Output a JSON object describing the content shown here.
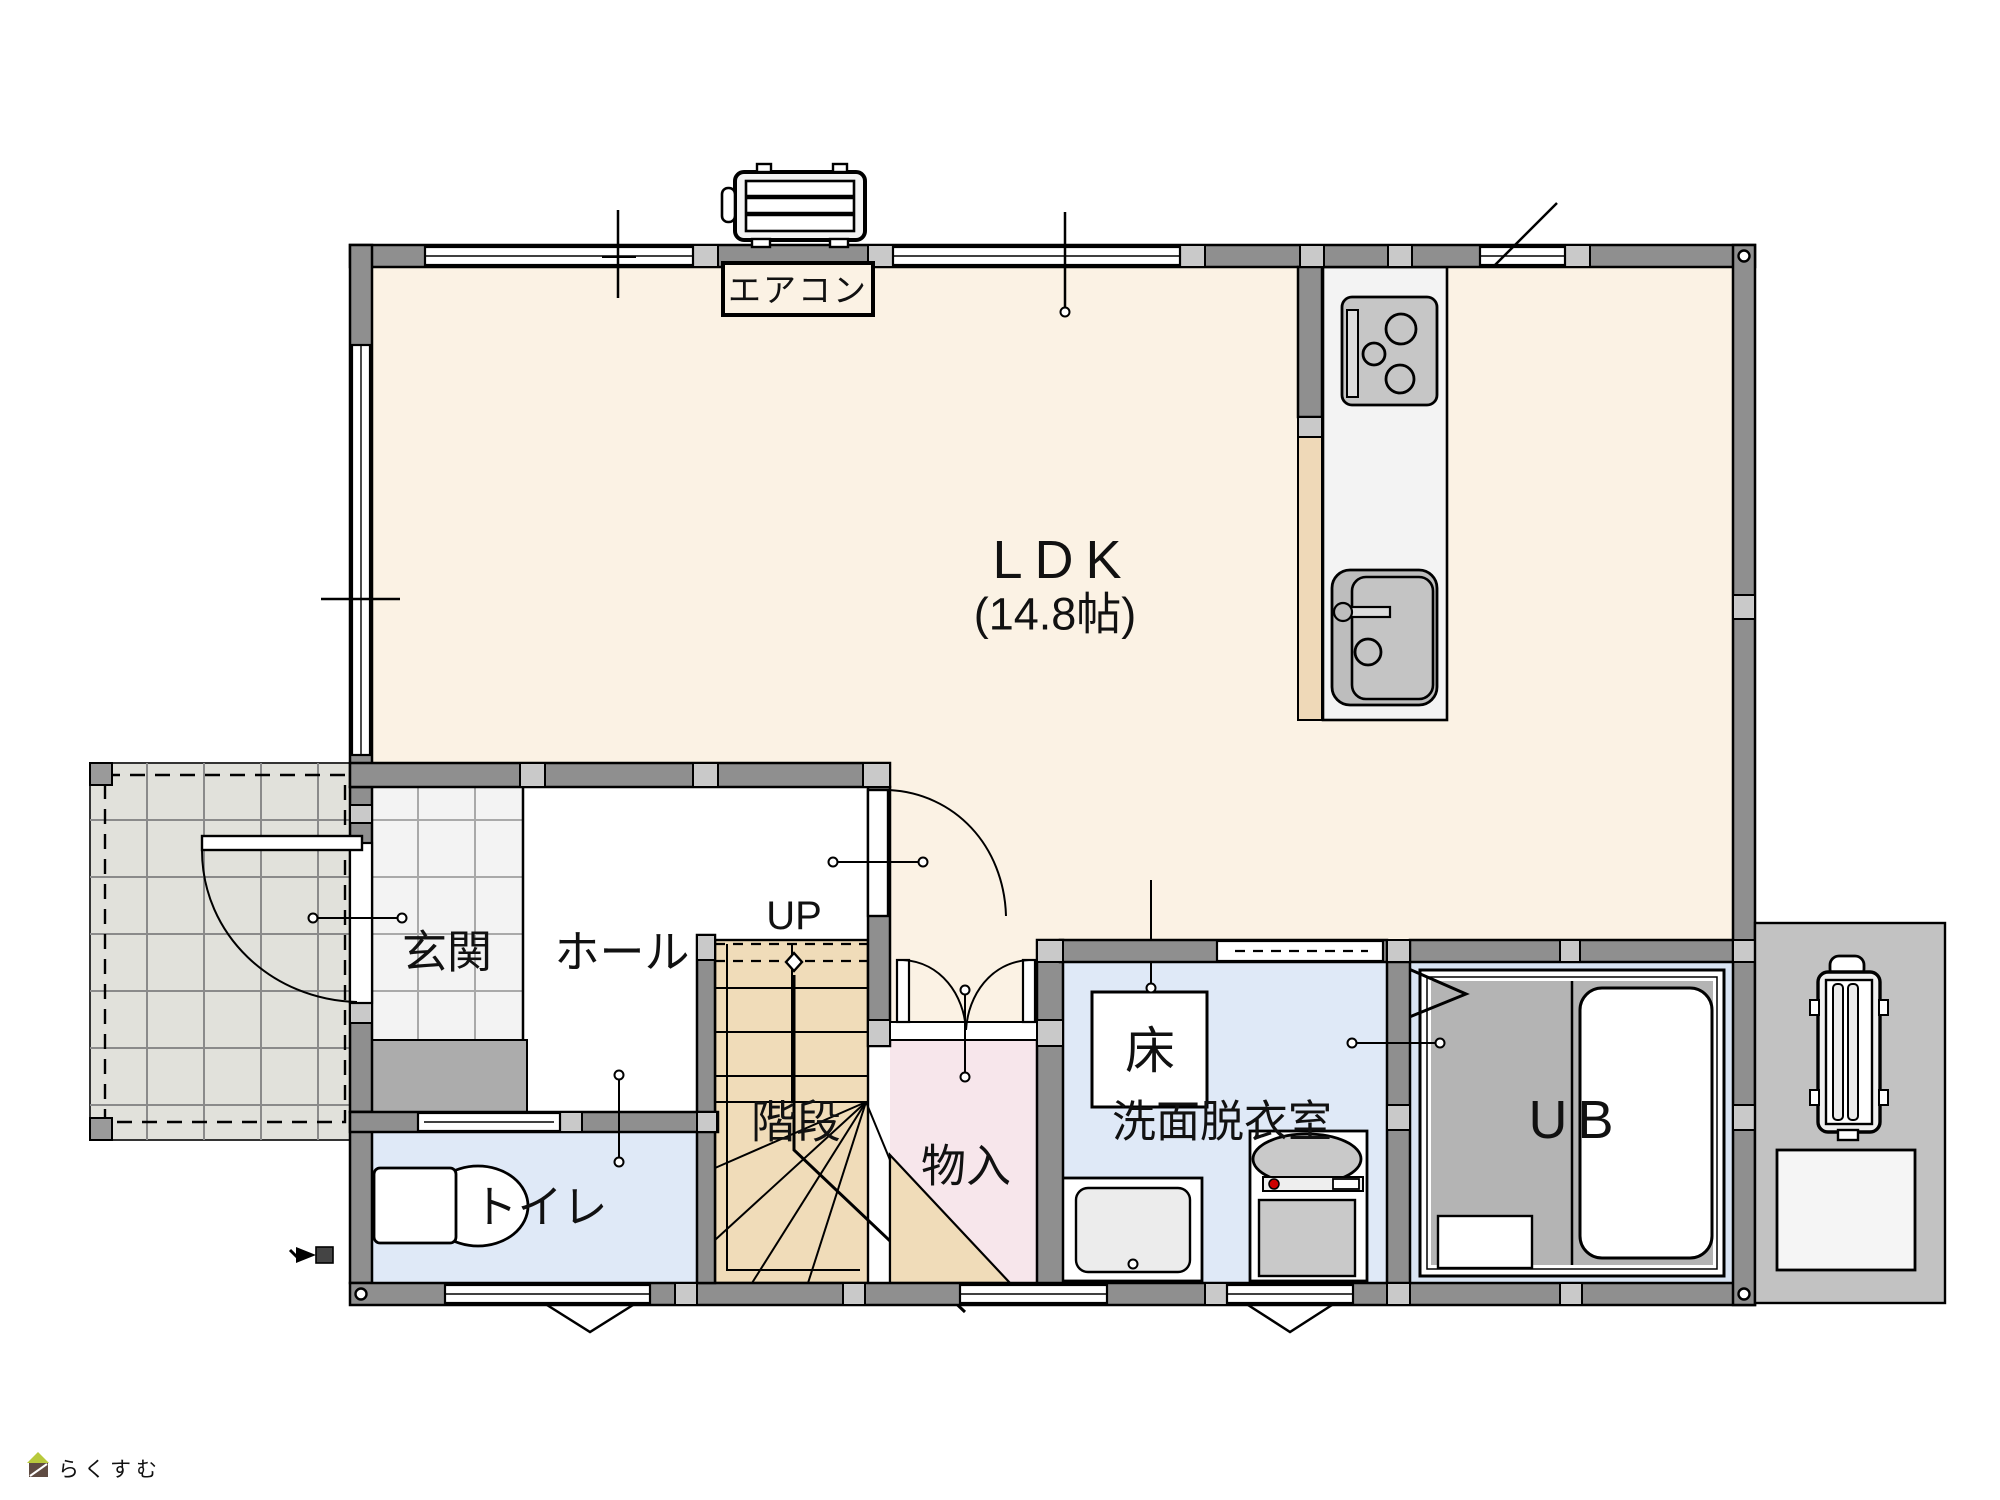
{
  "labels": {
    "aircon": "エアコン",
    "ldk": "LDK",
    "ldk_size": "(14.8帖)",
    "entrance": "玄関",
    "hall": "ホール",
    "up": "UP",
    "stairs": "階段",
    "closet": "物入",
    "toilet": "トイレ",
    "floor_hatch": "床",
    "washroom": "洗面脱衣室",
    "bath": "UB"
  },
  "watermark": {
    "text": "らくすむ"
  },
  "colors": {
    "wall": "#8F8F8F",
    "ldk_floor": "#FBF2E4",
    "entrance_tile": "#F3F3F3",
    "entrance_step": "#ACACAC",
    "stairs_floor": "#F0DCB9",
    "closet_floor": "#F7E6EB",
    "wet_room_floor": "#DFE9F7",
    "bath_floor": "#B4B4B4",
    "bath_margin": "#D9E4F3",
    "porch_tile": "#E1E1DB",
    "counter_half_wall": "#EFD9B8",
    "kitchen_counter": "#F3F3F3",
    "pad_gray": "#C2C2C2",
    "logo_text": "#8D7568",
    "logo_roof": "#B8C93C",
    "logo_body": "#5F4B42"
  }
}
